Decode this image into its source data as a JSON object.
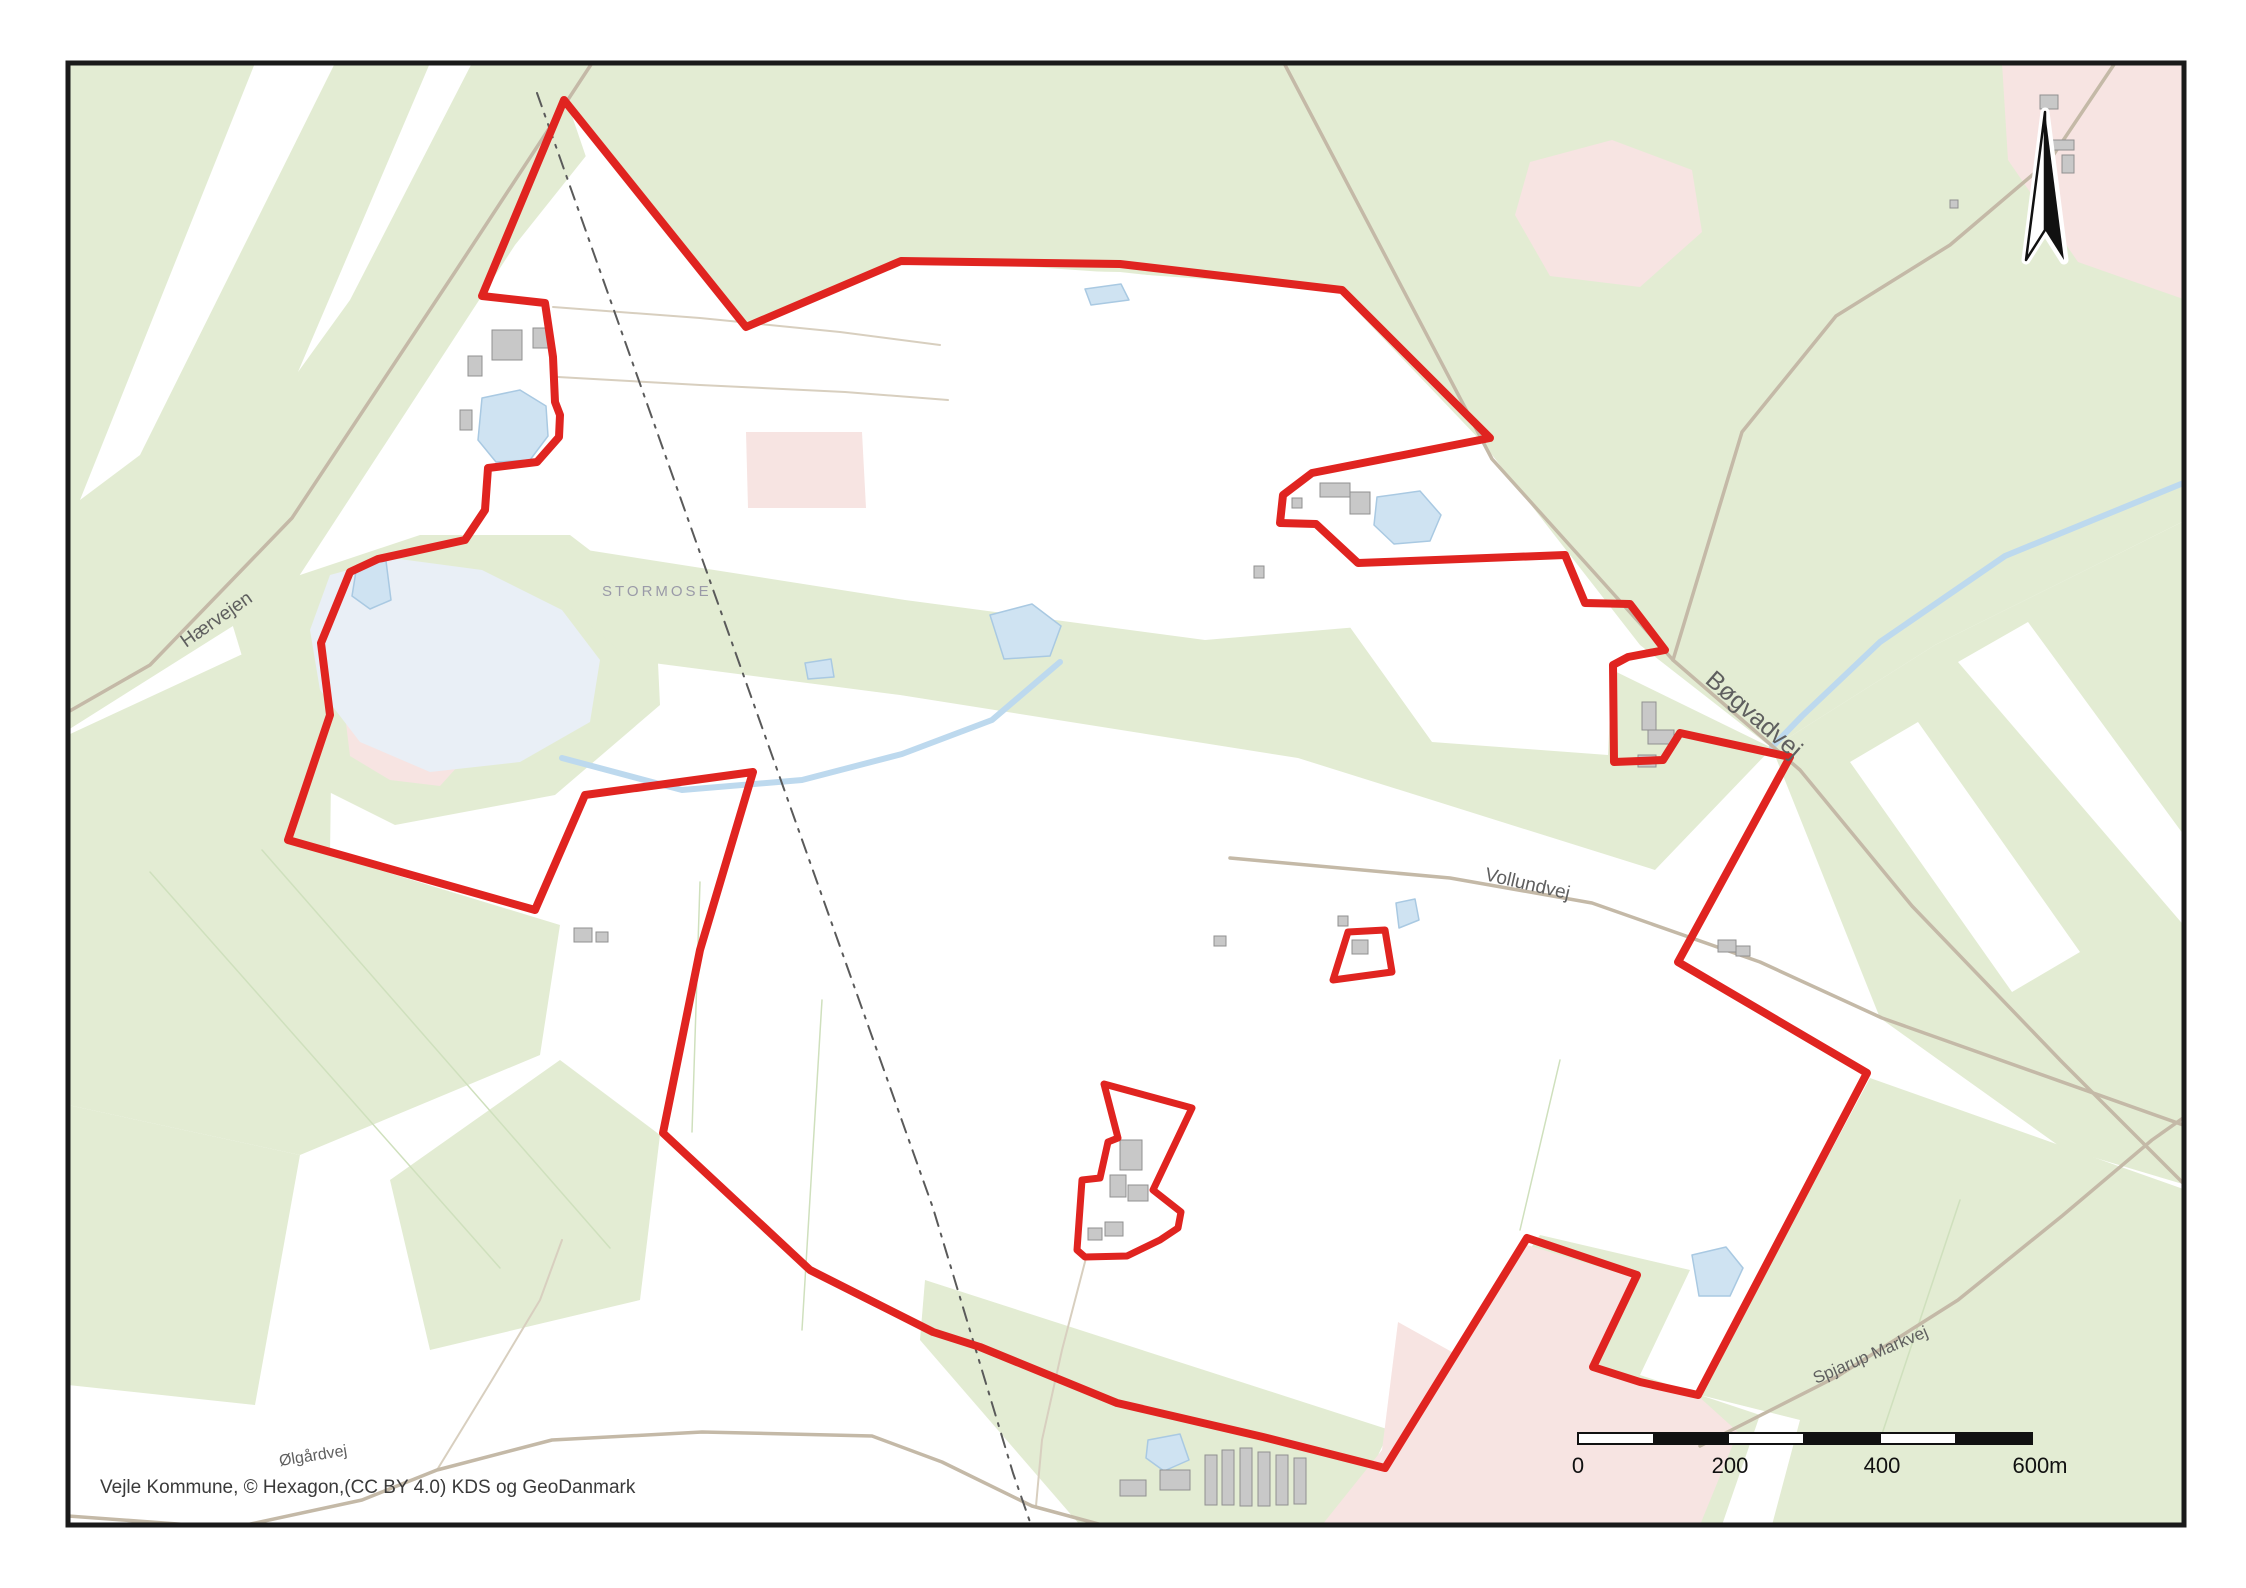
{
  "map": {
    "attribution": "Vejle Kommune, © Hexagon,(CC BY 4.0) KDS og GeoDanmark",
    "labels": {
      "stormose": {
        "text": "STORMOSE"
      },
      "haervejen": {
        "text": "Hærvejen"
      },
      "bogvadvej": {
        "text": "Bøgvadvej"
      },
      "vollundvej": {
        "text": "Vollundvej"
      },
      "spjarup": {
        "text": "Spjarup Markvej"
      },
      "olgardvej": {
        "text": "Ølgårdvej"
      }
    },
    "scalebar": {
      "ticks": [
        "0",
        "200",
        "400",
        "600m"
      ]
    },
    "north_arrow": "north-arrow",
    "colors": {
      "green": "#e3ecd3",
      "white_field": "#ffffff",
      "pink": "#f7e4e2",
      "lake": "#cfe3f2",
      "lake_stroke": "#a9c9e2",
      "lake_pale": "#e9eff6",
      "stream": "#bdd9ee",
      "road": "#c4b9a7",
      "road_minor": "#d8cfbf",
      "field_line": "#cfe0bd",
      "dashed_line": "#5a5a5a",
      "building_fill": "#c8c8c8",
      "building_stroke": "#909090",
      "boundary": "#e02420",
      "frame": "#1a1a1a",
      "scalebar_black": "#111111",
      "scalebar_white": "#ffffff"
    },
    "geometry": {
      "green_areas": [
        "68,63 660,63 515,245 290,590 68,730",
        "560,63 2186,63 2186,520 1935,645 1772,748 1640,645 1482,442 1335,288 902,258 746,325 564,100",
        "225,600 420,535 570,535 655,600 660,705 555,795 395,825 275,765",
        "555,545 905,600 1205,640 1500,615 1772,748 1655,870 1298,758 900,695 630,660 550,590",
        "68,735 262,645 332,705 330,855 560,925 540,1055 300,1155 68,1105",
        "68,1105 300,1155 255,1405 68,1385",
        "390,1180 560,1060 660,1135 640,1300 430,1350",
        "925,1280 1390,1430 1345,1525 1080,1525 920,1340",
        "1540,1235 1690,1270 1640,1375 1760,1415 1722,1525 1392,1525 1390,1445",
        "1870,1078 2186,1190 2186,1525 1772,1525 1800,1420 1700,1395",
        "1935,645 2186,520 2186,1185 2062,1148 1880,1018 1772,748"
      ],
      "white_fields": [
        "570,110 740,325 900,268 1120,272 1335,295 1470,436 1310,478 1284,500 1284,520 1316,528 1352,560 1150,572 920,560 750,480 645,330",
        "1285,475 1462,450 1600,602 1642,652 1612,668 1608,755 1432,742 1302,560",
        "255,63 335,63 140,455 80,500",
        "430,63 472,63 350,300 298,372",
        "1850,762 1918,722 2080,952 2012,992",
        "1958,662 2028,622 2186,838 2186,928"
      ],
      "pink_areas": [
        "1530,162 1612,140 1692,170 1702,232 1640,287 1550,276 1515,215",
        "2002,63 2186,63 2186,300 2078,262 2008,160",
        "345,715 398,700 442,716 472,700 477,745 440,786 390,780 350,756",
        "746,432 862,432 866,508 748,508",
        "1398,1322 1452,1352 1527,1245 1635,1278 1596,1364 1640,1384 1697,1395 1738,1432 1700,1525 1322,1525 1382,1450"
      ],
      "lake_pale": [
        "330,575 392,558 482,570 562,610 600,660 590,722 520,762 430,772 360,742 320,690 310,630"
      ],
      "lakes": [
        "482,398 520,390 546,406 548,436 530,460 496,462 478,440",
        "357,565 386,561 391,600 370,609 352,596",
        "1377,497 1420,491 1441,515 1430,541 1394,544 1374,525",
        "990,615 1032,604 1061,626 1050,656 1004,659",
        "805,663 831,659 834,677 808,679",
        "1692,1255 1726,1247 1743,1268 1730,1296 1699,1296",
        "1148,1440 1180,1434 1189,1460 1164,1471 1146,1458",
        "1396,903 1415,899 1419,920 1399,928",
        "1085,289 1121,284 1129,300 1091,305"
      ],
      "streams": [
        "2186,482 2005,556 1880,642 1802,716 1772,747",
        "562,758 682,790 802,780 902,754 992,720 1060,662"
      ],
      "roads_major": [
        "592,63 455,272 292,518 150,665 68,712",
        "1284,63 1492,459 1673,660 1800,770 1912,906 2062,1062 2186,1186",
        "2115,63 2050,160 1950,245 1836,316 1742,432 1673,660",
        "1230,858 1450,878 1592,903 1760,962 1882,1018 2186,1126",
        "68,1516 232,1528 362,1500 437,1470 552,1440 702,1432 872,1436 942,1462 1032,1506 1102,1525",
        "1700,1446 1838,1376 1958,1300 2062,1216 2152,1140 2186,1116"
      ],
      "roads_minor": [
        "437,1470 492,1380 540,1300 562,1240",
        "1086,1258 1062,1350 1042,1440 1036,1506",
        "553,307 700,318 840,332 940,345",
        "558,377 700,385 845,392 948,400"
      ],
      "field_lines": [
        "150,872 500,1268",
        "262,850 610,1248",
        "822,1000 802,1330",
        "700,882 692,1132",
        "1560,1060 1520,1230",
        "1960,1200 1880,1440"
      ],
      "dashed_boundary": [
        "537,93 673,477 933,1208 1013,1473 1030,1522"
      ],
      "buildings": [
        [
          492,
          330,
          30,
          30
        ],
        [
          533,
          328,
          16,
          20
        ],
        [
          468,
          356,
          14,
          20
        ],
        [
          460,
          410,
          12,
          20
        ],
        [
          1320,
          483,
          30,
          14
        ],
        [
          1350,
          492,
          20,
          22
        ],
        [
          1292,
          498,
          10,
          10
        ],
        [
          1642,
          702,
          14,
          28
        ],
        [
          1648,
          730,
          26,
          14
        ],
        [
          1638,
          755,
          18,
          12
        ],
        [
          1352,
          940,
          16,
          14
        ],
        [
          1338,
          916,
          10,
          10
        ],
        [
          1120,
          1140,
          22,
          30
        ],
        [
          1110,
          1175,
          16,
          22
        ],
        [
          1128,
          1185,
          20,
          16
        ],
        [
          1105,
          1222,
          18,
          14
        ],
        [
          1088,
          1228,
          14,
          12
        ],
        [
          1205,
          1455,
          12,
          50
        ],
        [
          1222,
          1450,
          12,
          55
        ],
        [
          1240,
          1448,
          12,
          58
        ],
        [
          1258,
          1452,
          12,
          54
        ],
        [
          1276,
          1455,
          12,
          50
        ],
        [
          1294,
          1458,
          12,
          46
        ],
        [
          1160,
          1470,
          30,
          20
        ],
        [
          1120,
          1480,
          26,
          16
        ],
        [
          574,
          928,
          18,
          14
        ],
        [
          596,
          932,
          12,
          10
        ],
        [
          1718,
          940,
          18,
          12
        ],
        [
          1736,
          946,
          14,
          10
        ],
        [
          2040,
          95,
          18,
          14
        ],
        [
          2052,
          140,
          22,
          10
        ],
        [
          2062,
          155,
          12,
          18
        ],
        [
          1950,
          200,
          8,
          8
        ],
        [
          1254,
          566,
          10,
          12
        ],
        [
          1214,
          936,
          12,
          10
        ]
      ],
      "site_boundary": {
        "main": "564,100 746,327 901,261 1120,264 1342,290 1490,438 1312,473 1283,495 1280,523 1316,524 1358,563 1565,555 1585,603 1630,604 1665,650 1628,657 1613,665 1614,762 1663,760 1680,733 1790,757 1678,962 1867,1073 1698,1395 1640,1382 1593,1367 1637,1275 1527,1238 1385,1468 1263,1437 1117,1403 980,1347 933,1332 810,1270 663,1133 700,950 753,772 585,795 535,910 288,840 330,715 321,643 350,572 378,559 465,540 485,510 488,468 537,462 559,437 560,415 555,402 553,357 545,303 482,296",
        "enclaves": [
          "1348,932 1385,930 1392,972 1333,980",
          "1104,1084 1192,1108 1153,1190 1181,1212 1178,1228 1160,1240 1127,1256 1085,1257 1077,1250 1082,1180 1100,1178 1108,1142 1118,1138"
        ]
      }
    }
  }
}
